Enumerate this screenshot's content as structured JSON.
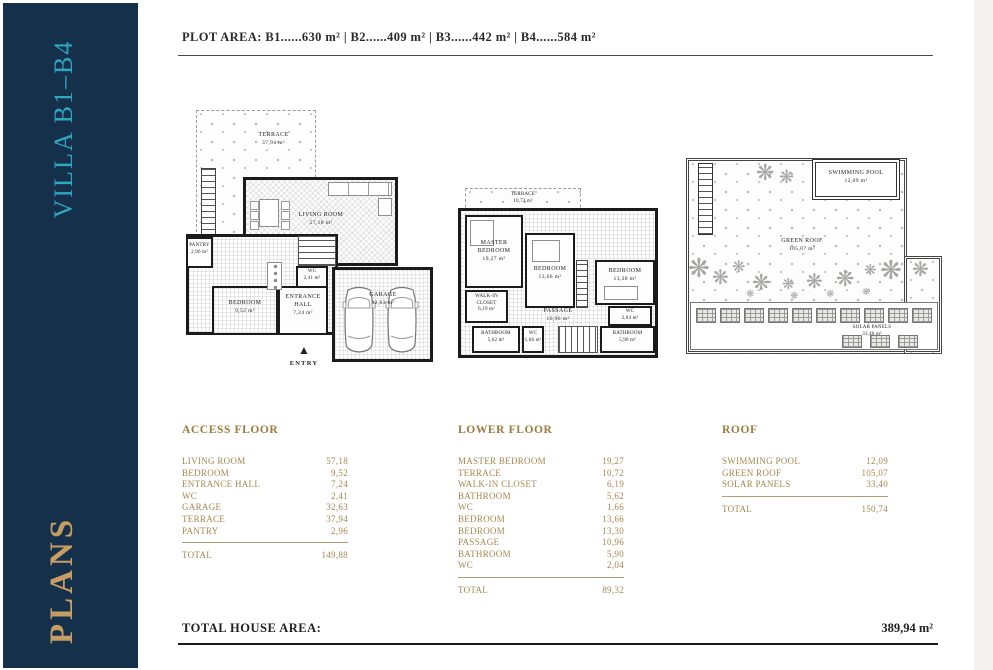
{
  "sidebar": {
    "title": "VILLA B1–B4",
    "footer": "PLANS"
  },
  "header": {
    "plot_area": "PLOT AREA: B1......630 m²   |   B2......409 m²   |   B3......442 m²   |   B4......584 m²"
  },
  "plans": {
    "access": {
      "entry_label": "ENTRY",
      "rooms": {
        "terrace": {
          "name": "TERRACE",
          "area": "37,94 m²"
        },
        "living": {
          "name": "LIVING ROOM",
          "area": "57,18 m²"
        },
        "pantry": {
          "name": "PANTRY",
          "area": "2,96 m²"
        },
        "bedroom": {
          "name": "BEDROOM",
          "area": "9,52 m²"
        },
        "wc": {
          "name": "WC",
          "area": "2,41 m²"
        },
        "entrance": {
          "name": "ENTRANCE HALL",
          "area": "7,24 m²"
        },
        "garage": {
          "name": "GARAGE",
          "area": "32,63 m²"
        }
      }
    },
    "lower": {
      "rooms": {
        "terrace": {
          "name": "TERRACE",
          "area": "10,72 m²"
        },
        "master": {
          "name": "MASTER BEDROOM",
          "area": "19,27 m²"
        },
        "bedroom1": {
          "name": "BEDROOM",
          "area": "13,66 m²"
        },
        "bedroom2": {
          "name": "BEDROOM",
          "area": "13,30 m²"
        },
        "closet": {
          "name": "WALK-IN CLOSET",
          "area": "6,19 m²"
        },
        "bath1": {
          "name": "BATHROOM",
          "area": "5,62 m²"
        },
        "wc1": {
          "name": "WC",
          "area": "1,66 m²"
        },
        "passage": {
          "name": "PASSAGE",
          "area": "10,96 m²"
        },
        "bath2": {
          "name": "BATHROOM",
          "area": "5,90 m²"
        },
        "wc2": {
          "name": "WC",
          "area": "2,04 m²"
        }
      }
    },
    "roof": {
      "rooms": {
        "pool": {
          "name": "SWIMMING POOL",
          "area": "12,09 m²"
        },
        "green": {
          "name": "GREEN ROOF",
          "area": "105,07 m²"
        },
        "solar": {
          "name": "SOLAR PANELS",
          "area": "33,40 m²"
        }
      }
    }
  },
  "tables": {
    "access": {
      "title": "ACCESS FLOOR",
      "rows": [
        {
          "label": "LIVING ROOM",
          "value": "57,18"
        },
        {
          "label": "BEDROOM",
          "value": "9,52"
        },
        {
          "label": "ENTRANCE HALL",
          "value": "7,24"
        },
        {
          "label": "WC",
          "value": "2,41"
        },
        {
          "label": "GARAGE",
          "value": "32,63"
        },
        {
          "label": "TERRACE",
          "value": "37,94"
        },
        {
          "label": "PANTRY",
          "value": "2,96"
        }
      ],
      "total_label": "TOTAL",
      "total_value": "149,88"
    },
    "lower": {
      "title": "LOWER FLOOR",
      "rows": [
        {
          "label": "MASTER BEDROOM",
          "value": "19,27"
        },
        {
          "label": "TERRACE",
          "value": "10,72"
        },
        {
          "label": "WALK-IN CLOSET",
          "value": "6,19"
        },
        {
          "label": "BATHROOM",
          "value": "5,62"
        },
        {
          "label": "WC",
          "value": "1,66"
        },
        {
          "label": "BEDROOM",
          "value": "13,66"
        },
        {
          "label": "BEDROOM",
          "value": "13,30"
        },
        {
          "label": "PASSAGE",
          "value": "10,96"
        },
        {
          "label": "BATHROOM",
          "value": "5,90"
        },
        {
          "label": "WC",
          "value": "2,04"
        }
      ],
      "total_label": "TOTAL",
      "total_value": "89,32"
    },
    "roof": {
      "title": "ROOF",
      "rows": [
        {
          "label": "SWIMMING POOL",
          "value": "12,09"
        },
        {
          "label": "GREEN ROOF",
          "value": "105,07"
        },
        {
          "label": "SOLAR PANELS",
          "value": "33,40"
        }
      ],
      "total_label": "TOTAL",
      "total_value": "150,74"
    }
  },
  "footer": {
    "label": "TOTAL HOUSE AREA:",
    "value": "389,94 m²"
  },
  "icons": {
    "tree": "❋",
    "entry_arrow": "▲"
  },
  "colors": {
    "sidebar_bg": "#15304a",
    "sidebar_title": "#2fa6c2",
    "sidebar_gold": "#c69d62",
    "table_gold": "#a4874e",
    "wall": "#1b1b1b",
    "page_edge": "#f4f2ee"
  }
}
